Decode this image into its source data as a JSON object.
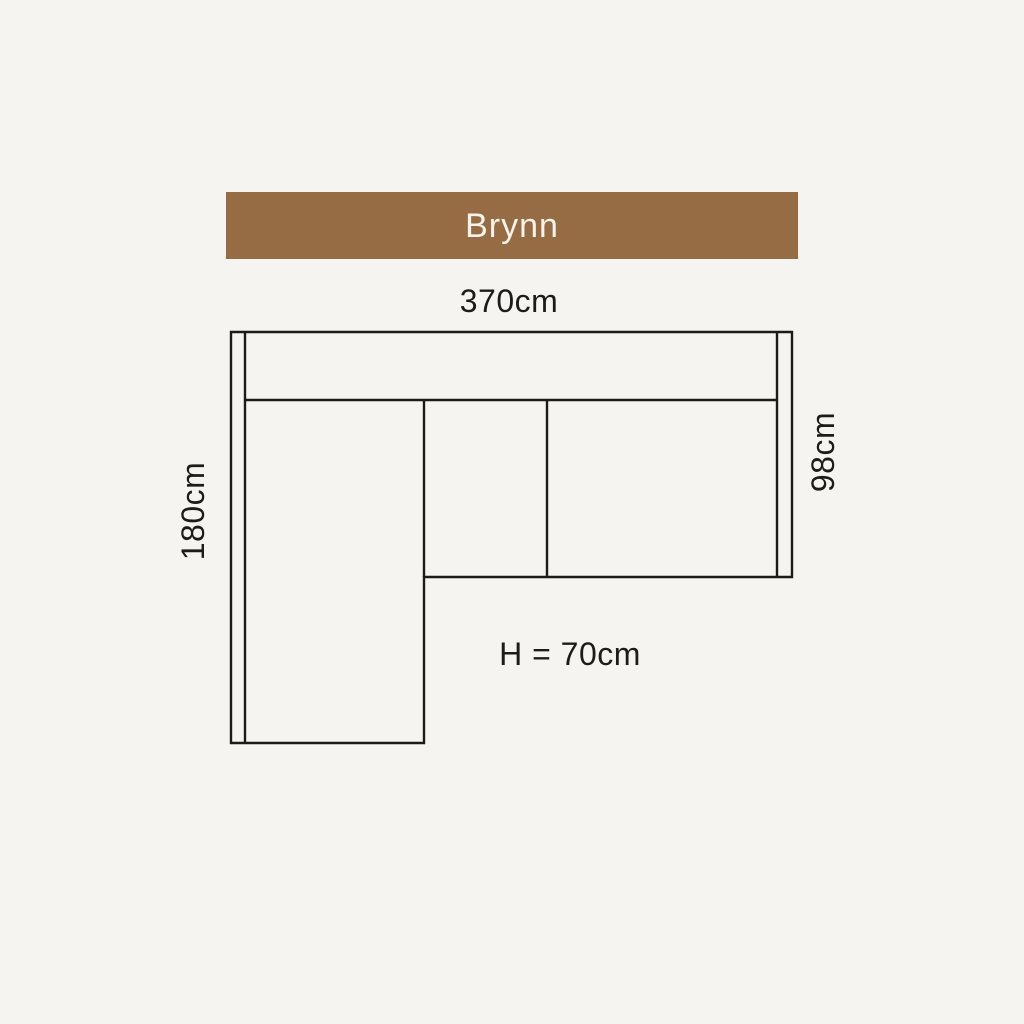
{
  "product": {
    "name": "Brynn"
  },
  "banner": {
    "label": "Brynn",
    "background_color": "#966c45",
    "text_color": "#f8f2ea"
  },
  "diagram": {
    "description": "Top-down dimension diagram of an L-shaped corner sofa with left chaise",
    "line_color": "#1c1b19",
    "background_color": "#f5f4f0",
    "labels": {
      "total_width": "370cm",
      "chaise_depth": "180cm",
      "sofa_depth": "98cm",
      "height": "H = 70cm"
    }
  }
}
